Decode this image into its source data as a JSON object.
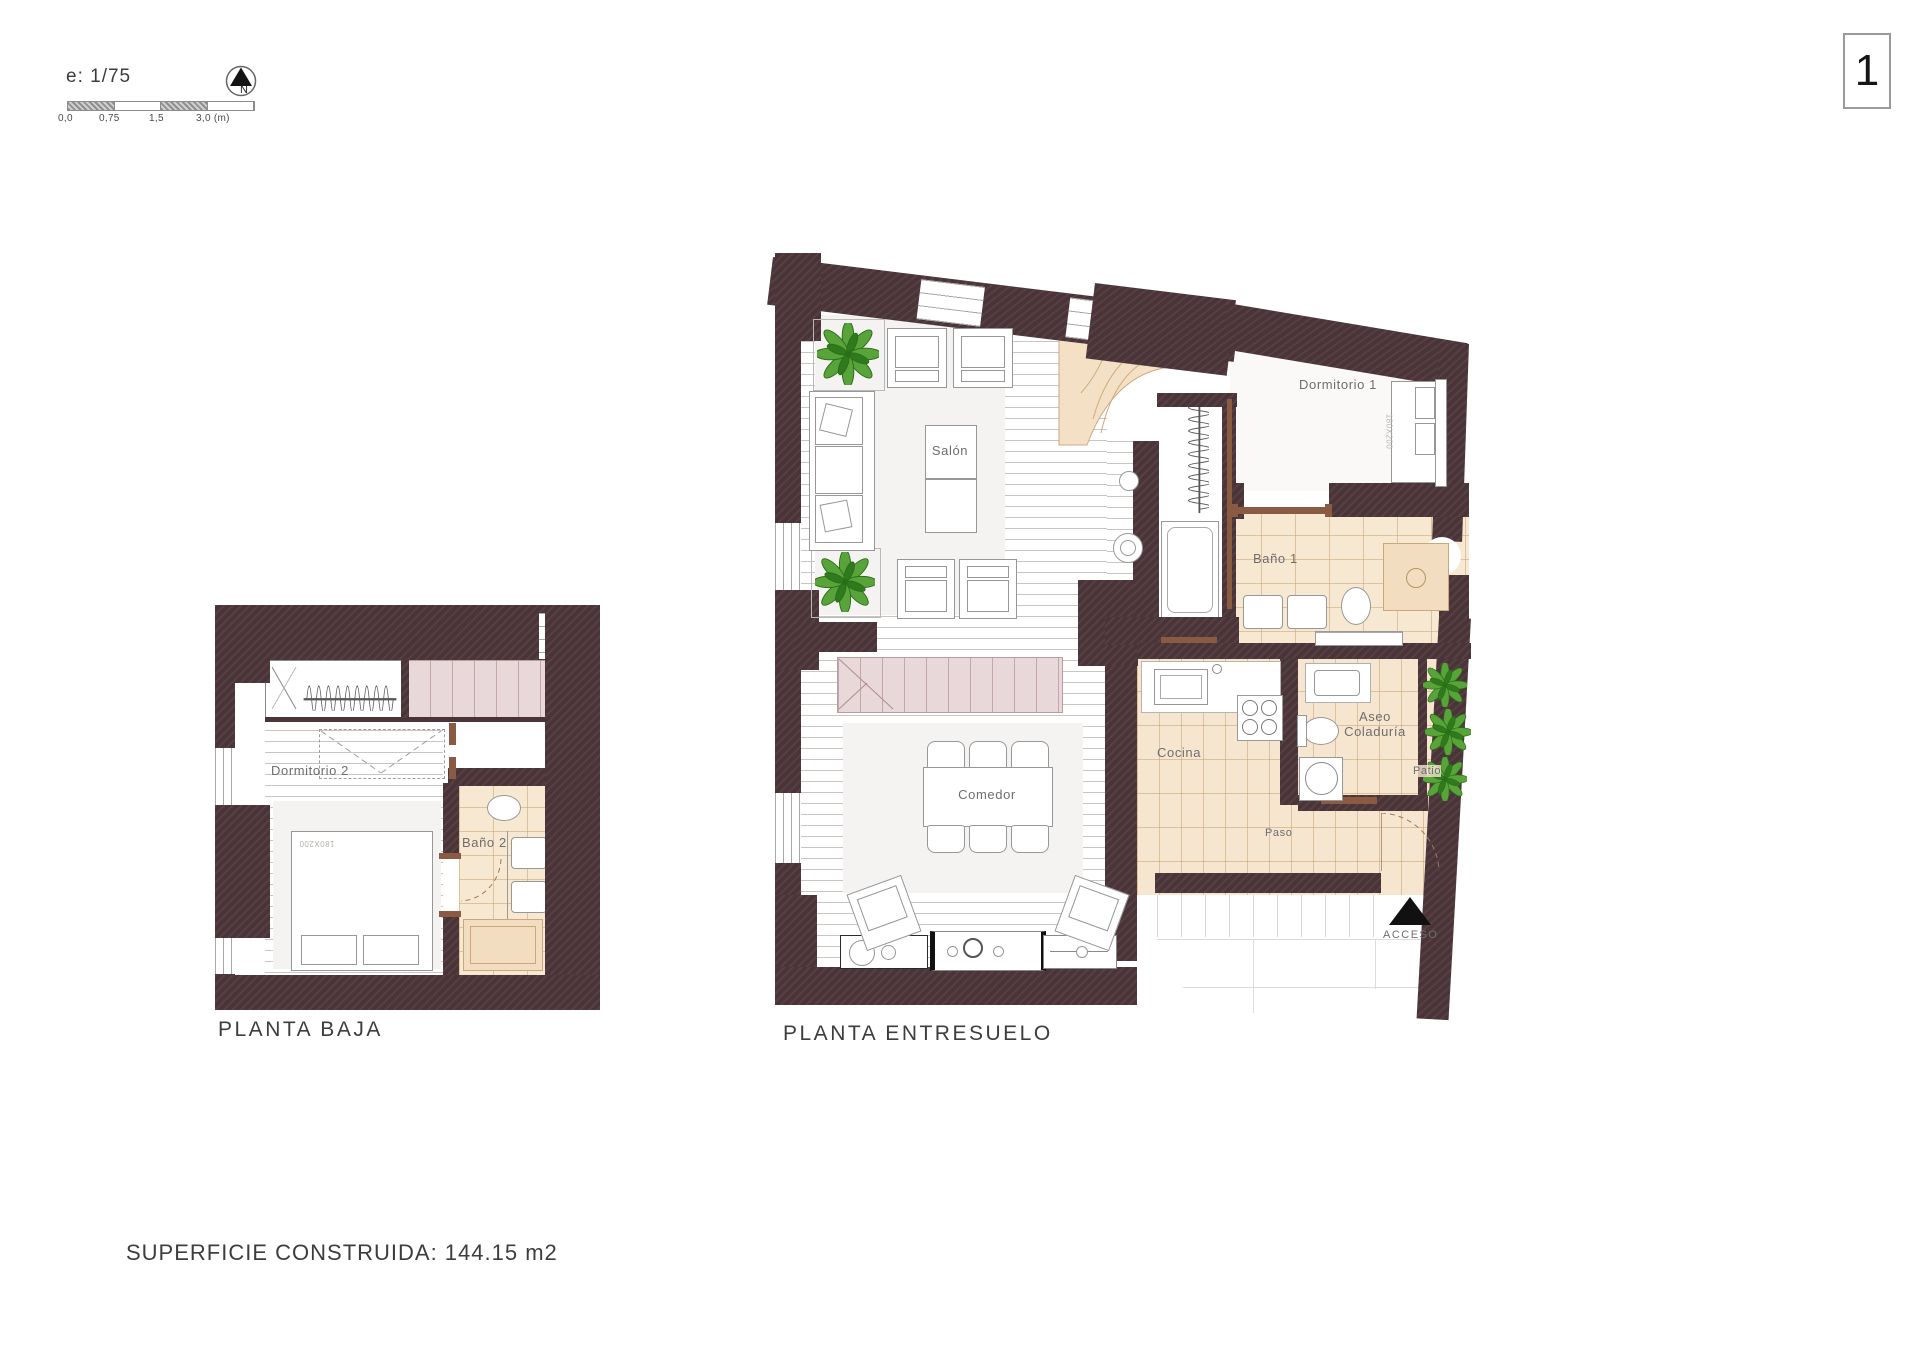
{
  "header": {
    "scale_label": "e: 1/75",
    "scale_ticks": [
      "0,0",
      "0,75",
      "1,5",
      "3,0 (m)"
    ],
    "north_label": "N",
    "sheet_number": "1"
  },
  "plans": {
    "baja": {
      "title": "PLANTA BAJA",
      "rooms": {
        "dormitorio2": "Dormitorio 2",
        "bano2": "Baño 2"
      },
      "bed_label": "180X200"
    },
    "entresuelo": {
      "title": "PLANTA ENTRESUELO",
      "rooms": {
        "salon": "Salón",
        "dormitorio1": "Dormitorio 1",
        "bano1": "Baño 1",
        "cocina": "Cocina",
        "aseo": "Aseo Coladuría",
        "patio": "Patio",
        "paso": "Paso",
        "comedor": "Comedor"
      },
      "bed_label": "180X200",
      "access_label": "ACCESO"
    }
  },
  "footer": {
    "area_label": "SUPERFICIE CONSTRUIDA: 144.15 m2"
  },
  "colors": {
    "wall": "#4a3438",
    "tile": "#f6e7d0",
    "stair_pink": "#e9d8d9",
    "plant_green": "#4e9b2f",
    "wood_line": "#c9c5c1",
    "door_wood": "#8a5a42"
  }
}
